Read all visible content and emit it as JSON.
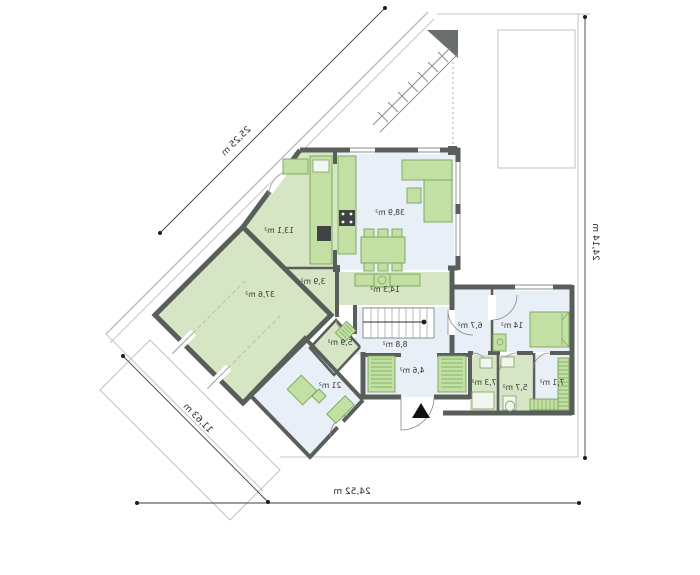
{
  "plan_title": "ground-floor-plan",
  "rooms": {
    "living": {
      "label": "38,9 m²"
    },
    "kitchen": {
      "label": "13,1 m²"
    },
    "garage": {
      "label": "37,6 m²"
    },
    "dining": {
      "label": "14,3 m²"
    },
    "pantry": {
      "label": "3,9 m²"
    },
    "boiler": {
      "label": "5,9 m²"
    },
    "hall": {
      "label": "8,8 m²"
    },
    "office": {
      "label": "21 m²"
    },
    "entry": {
      "label": "4,6 m²"
    },
    "corridor": {
      "label": "6,7 m²"
    },
    "bedroom": {
      "label": "14 m²"
    },
    "bath_large": {
      "label": "7,3 m²"
    },
    "bath_small": {
      "label": "5,7 m²"
    },
    "wardrobe": {
      "label": "7,1 m²"
    }
  },
  "dimensions": {
    "left_diagonal": "25,25 m",
    "right_side": "24,14 m",
    "bottom": "24,52 m",
    "bottom_left_diagonal": "11,63 m"
  },
  "colors": {
    "wall": "#5a5e5b",
    "room_blue": "#e9eff7",
    "room_green": "#d6e5c4",
    "furniture": "#c3e0a4",
    "plot_line": "#c6c6c6",
    "dimension_line": "#3c3c3c"
  },
  "icons": {
    "entrance_arrow": "up-triangle",
    "north_wedge": "dark-triangle"
  }
}
